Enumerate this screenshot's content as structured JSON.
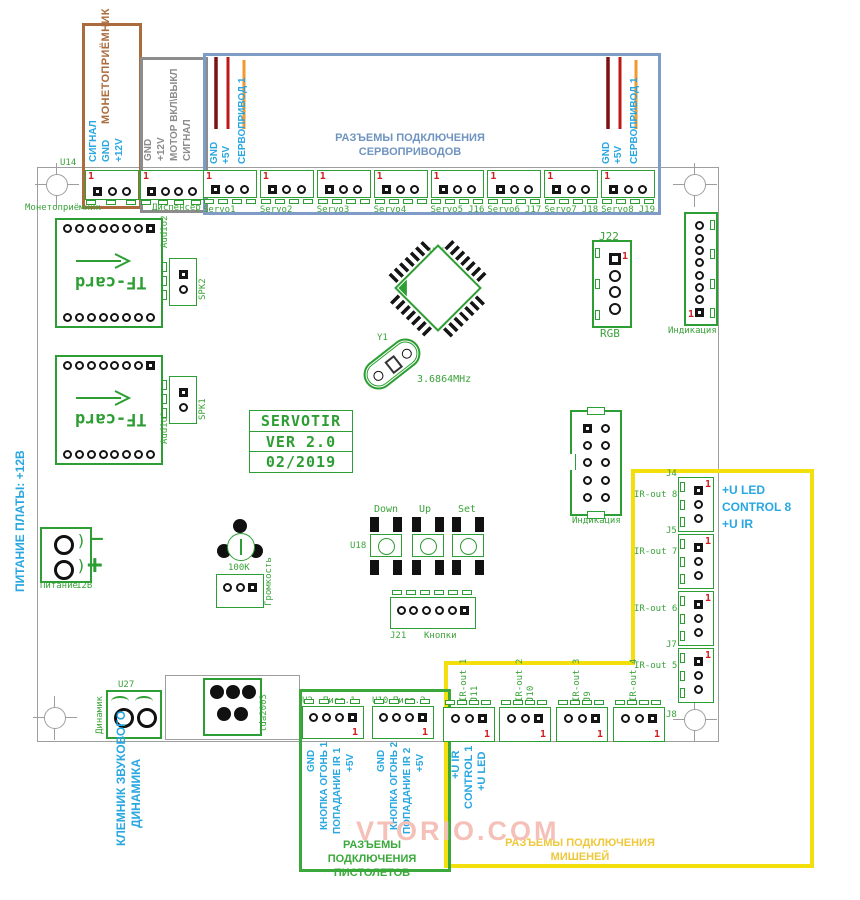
{
  "pin1": "1",
  "watermark": "VTORIO.COM",
  "colors": {
    "silk_green": "#2d9e33",
    "ref_red": "#cf1d1d",
    "note_blue": "#29a7e1",
    "coin_brown": "#ab6b3c",
    "dispenser_gray": "#8c8c8c",
    "servo_blue": "#7e9cc5",
    "target_yellow": "#f2df0c",
    "target_text_yellow": "#eec83c",
    "wire_dark_red": "#7c1012",
    "wire_red": "#c01718",
    "wire_orange": "#f2992e",
    "watermark_pink": "#f5c0b8"
  },
  "top": {
    "u14": "U14",
    "coin": {
      "title": "МОНЕТОПРИЁМНИК",
      "pin_labels": [
        "СИГНАЛ",
        "GND",
        "+12V"
      ],
      "board_label": "Монетоприёмник"
    },
    "dispenser": {
      "pin_labels": [
        "GND",
        "+12V",
        "МОТОР ВКЛ\\ВЫКЛ",
        "СИГНАЛ"
      ],
      "board_label": "Диспенсер"
    },
    "servo": {
      "caption1": "РАЗЪЕМЫ ПОДКЛЮЧЕНИЯ",
      "caption2": "СЕРВОПРИВОДОВ",
      "wire_labels": [
        "GND",
        "+5V",
        "СЕРВОПРИВОД 1"
      ],
      "connectors": [
        {
          "name": "Servo1",
          "j": ""
        },
        {
          "name": "Servo2",
          "j": ""
        },
        {
          "name": "Servo3",
          "j": ""
        },
        {
          "name": "Servo4",
          "j": ""
        },
        {
          "name": "Servo5",
          "j": "J16"
        },
        {
          "name": "Servo6",
          "j": "J17"
        },
        {
          "name": "Servo7",
          "j": "J18"
        },
        {
          "name": "Servo8",
          "j": "J19"
        }
      ]
    }
  },
  "audio": {
    "tf_card": "TF-card",
    "audio2": "Audio2",
    "spk2": "SPK2",
    "audio1": "Audio1",
    "spk1": "SPK1"
  },
  "center": {
    "u56": "U56",
    "y1": "Y1",
    "freq": "3.6864MHz",
    "j22": "J22",
    "rgb": "RGB",
    "indication": "Индикация",
    "idc_indication": "Индикация",
    "u18": "U18",
    "buttons": [
      "Down",
      "Up",
      "Set"
    ],
    "j21": "J21",
    "keys": "Кнопки",
    "pot_value": "100K",
    "volume": "Громкость"
  },
  "title_block": {
    "line1": "SERVOTIR",
    "line2": "VER 2.0",
    "line3": "02/2019"
  },
  "power": {
    "note": "ПИТАНИЕ ПЛАТЫ: +12В",
    "label": "Питание",
    "voltage": "12В",
    "minus": "–",
    "plus": "+"
  },
  "speaker": {
    "u27": "U27",
    "dynamic": "Динамик",
    "amp": "tda2003",
    "note1": "КЛЕМНИК ЗВУКОВОГО",
    "note2": "ДИНАМИКА"
  },
  "pistols": {
    "caption1": "РАЗЪЕМЫ ПОДКЛЮЧЕНИЯ",
    "caption2": "ПИСТОЛЕТОВ",
    "p1": {
      "ref": "U2",
      "name": "Пист.1",
      "pin_labels": [
        "GND",
        "КНОПКА ОГОНЬ 1",
        "ПОПАДАНИЕ IR 1",
        "+5V"
      ]
    },
    "p2": {
      "ref": "U10",
      "name": "Пист.2",
      "pin_labels": [
        "GND",
        "КНОПКА ОГОНЬ 2",
        "ПОПАДАНИЕ IR 2",
        "+5V"
      ]
    }
  },
  "targets": {
    "caption1": "РАЗЪЕМЫ ПОДКЛЮЧЕНИЯ",
    "caption2": "МИШЕНЕЙ",
    "right_note": [
      "+U LED",
      "CONTROL 8",
      "+U IR"
    ],
    "right": [
      {
        "j": "J4",
        "label": "IR-out 8"
      },
      {
        "j": "J5",
        "label": "IR-out 7"
      },
      {
        "j": "",
        "label": "IR-out 6"
      },
      {
        "j": "J7",
        "label": "IR-out 5"
      }
    ],
    "bottom": [
      {
        "label": "IR-out 1",
        "j": "J11"
      },
      {
        "label": "IR-out 2",
        "j": "J10"
      },
      {
        "label": "IR-out 3",
        "j": "J9"
      },
      {
        "label": "IR-out 4",
        "j": ""
      }
    ],
    "j8": "J8",
    "bottom_note": [
      "+U IR",
      "CONTROL 1",
      "+U LED"
    ]
  }
}
